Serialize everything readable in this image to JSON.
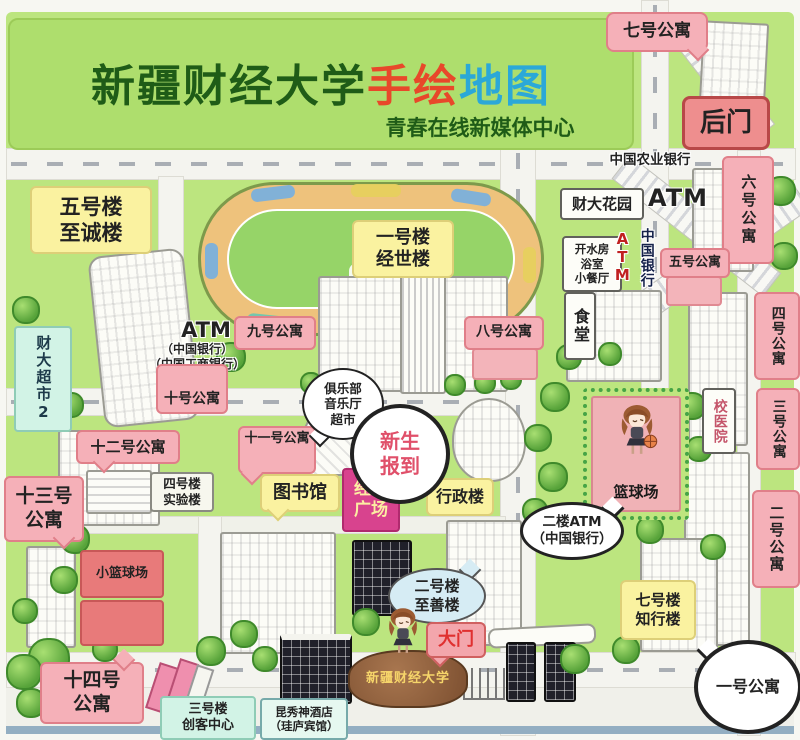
{
  "title": {
    "main": "新疆财经大学",
    "accent_red": "手绘",
    "accent_blue": "地图",
    "subtitle": "青春在线新媒体中心"
  },
  "labels": {
    "apt7": "七号公寓",
    "houmen": "后门",
    "apt6": "六号公寓",
    "agri_bank": "中国农业银行",
    "atm_top": "ATM",
    "caida_garden": "财大花园",
    "boiler": "开水房\n浴室\n小餐厅",
    "boc_vert": "中国银行",
    "atm_vert": "ATM",
    "apt5": "五号公寓",
    "canteen": "食堂",
    "apt4": "四号公寓",
    "apt3": "三号公寓",
    "apt2": "二号公寓",
    "hospital": "校医院",
    "bldg5": "五号楼\n至诚楼",
    "supermarket": "财大超市2",
    "atm_left_title": "ATM",
    "atm_left_sub": "（中国银行）\n（中国工商银行）",
    "apt10": "十号公寓",
    "apt9": "九号公寓",
    "apt8": "八号公寓",
    "bldg1": "一号楼\n经世楼",
    "apt12": "十二号公寓",
    "bldg4": "四号楼\n实验楼",
    "apt13": "十三号\n公寓",
    "apt11": "十一号公寓",
    "club": "俱乐部\n音乐厅\n超市",
    "freshman": "新生\n报到",
    "library": "图书馆",
    "jingshi": "经世\n广场",
    "admin": "行政楼",
    "court": "篮球场",
    "small_court": "小篮球场",
    "atm_2f": "二楼ATM\n（中国银行）",
    "bldg2": "二号楼\n至善楼",
    "gate": "大门",
    "stone": "新疆财经大学",
    "bldg7": "七号楼\n知行楼",
    "apt1": "一号公寓",
    "apt14": "十四号\n公寓",
    "bldg3": "三号楼\n创客中心",
    "hotel": "昆秀神酒店\n（珪庐宾馆）"
  },
  "colors": {
    "map_green": "#bce57f",
    "banner_green": "#aede6d",
    "title_green": "#1f5c17",
    "title_red": "#e8482a",
    "title_blue": "#2ba8d8",
    "label_pink": "#f5b0b8",
    "label_yellow": "#faf2a0",
    "magenta_plaza": "#d8438e",
    "red_court": "#e87a7a",
    "gate_red": "#e03030"
  }
}
